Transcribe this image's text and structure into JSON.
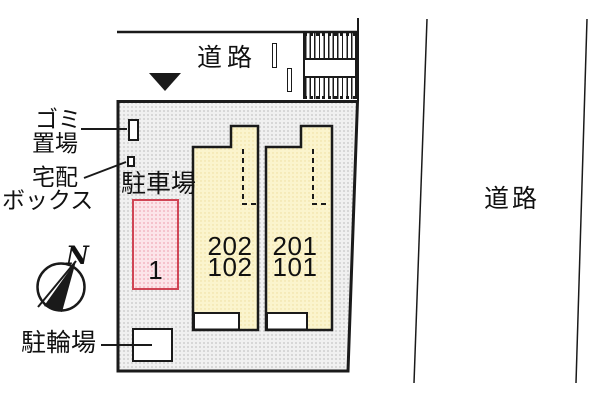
{
  "plan": {
    "title_hint": "apartment site plan",
    "roads": {
      "top": {
        "label": "道路"
      },
      "right": {
        "label": "道路"
      }
    },
    "annotations": {
      "garbage_line1": "ゴミ",
      "garbage_line2": "置場",
      "delivery_line1": "宅配",
      "delivery_line2": "ボックス",
      "parking_area": "駐車場",
      "bicycle_parking": "駐輪場"
    },
    "compass": {
      "north": "N"
    },
    "parking_spot": {
      "number": "1"
    },
    "units": [
      {
        "upper": "202",
        "lower": "102"
      },
      {
        "upper": "201",
        "lower": "101"
      }
    ],
    "colors": {
      "line": "#1a1a1a",
      "site_fill": "#f0f0f0",
      "building_fill": "#fbf4cd",
      "parking_spot_fill": "#fce4e9",
      "parking_spot_border": "#d04455"
    }
  }
}
